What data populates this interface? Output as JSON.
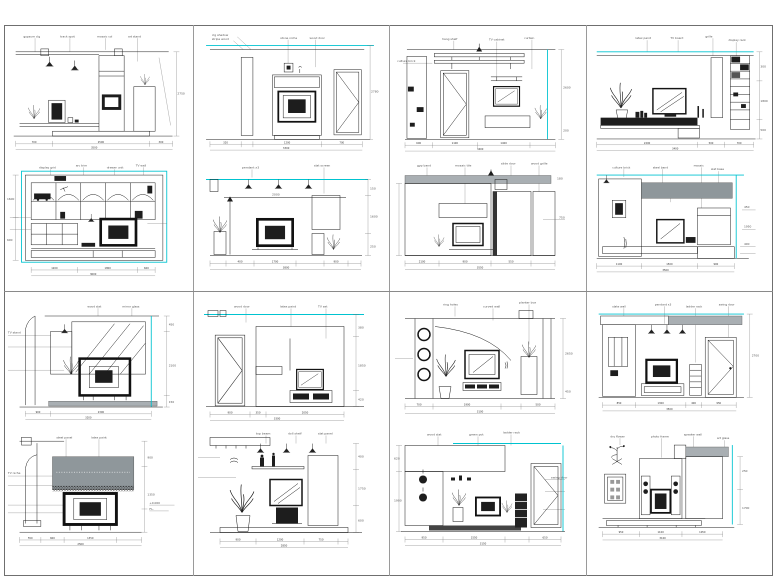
{
  "sheet": {
    "background": "#ffffff",
    "frame_color": "#6f6f6f",
    "grid_color": "#9a9a9a",
    "line_color": "#1a1a1a",
    "accent_cyan": "#00c3d0",
    "band_gray": "#a9afb3",
    "dark_fill": "#1d1d1d",
    "layout": "4 columns x 2 rows of cells, 2 elevation drawings per cell"
  },
  "panels": [
    {
      "id": "elev-1a",
      "annos": [
        "gypsum clg",
        "track spot",
        "mosaic col",
        "art stand"
      ],
      "dims": [
        "700",
        "2500",
        "300",
        "3500"
      ],
      "vdims": [
        "2750"
      ]
    },
    {
      "id": "elev-2a",
      "annos": [
        "clg shadow",
        "stripe wood",
        "stone niche",
        "wood door"
      ],
      "dims": [
        "320",
        "1200",
        "700",
        "3300"
      ],
      "vdims": [
        "2780"
      ]
    },
    {
      "id": "elev-3a",
      "annos": [
        "hang shelf",
        "culture brick",
        "TV cabinet",
        "curtain"
      ],
      "dims": [
        "600",
        "1100",
        "1400",
        "3400"
      ],
      "vdims": [
        "2600",
        "200"
      ]
    },
    {
      "id": "elev-4a",
      "annos": [
        "latex paint",
        "TV board",
        "grille",
        "display rack"
      ],
      "dims": [
        "2200",
        "500",
        "700",
        "3400"
      ],
      "vdims": [
        "300",
        "1800",
        "500"
      ]
    },
    {
      "id": "elev-1b",
      "annos": [
        "display grid",
        "arc trim",
        "drawer unit",
        "TV wall"
      ],
      "dims": [
        "1200",
        "1800",
        "600",
        "3600"
      ],
      "vdims": [
        "1600",
        "600"
      ]
    },
    {
      "id": "elev-2b",
      "annos": [
        "pendant x3",
        "2000",
        "slat screen"
      ],
      "dims": [
        "400",
        "1700",
        "900",
        "3800"
      ],
      "vdims": [
        "150",
        "1600",
        "250"
      ]
    },
    {
      "id": "elev-3b",
      "annos": [
        "gyp band",
        "mosaic tile",
        "slide door",
        "wood grille"
      ],
      "dims": [
        "2100",
        "900",
        "550",
        "3550"
      ],
      "vdims": [
        "750",
        "180"
      ]
    },
    {
      "id": "elev-4b",
      "annos": [
        "culture brick",
        "steel band",
        "mosaic",
        "slat base"
      ],
      "dims": [
        "1100",
        "1500",
        "900",
        "3500"
      ],
      "vdims": [
        "450",
        "1950",
        "400"
      ]
    },
    {
      "id": "elev-5a",
      "annos": [
        "wood slat",
        "mirror glass",
        "TV stand"
      ],
      "dims": [
        "900",
        "2300",
        "3200"
      ],
      "vdims": [
        "450",
        "2100",
        "150"
      ]
    },
    {
      "id": "elev-6a",
      "annos": [
        "wood door",
        "latex paint",
        "TV set"
      ],
      "dims": [
        "900",
        "350",
        "2050",
        "3300"
      ],
      "vdims": [
        "380",
        "1850",
        "420"
      ]
    },
    {
      "id": "elev-7a",
      "annos": [
        "ring holes",
        "curved wall",
        "planter box"
      ],
      "dims": [
        "700",
        "1900",
        "500",
        "3100"
      ],
      "vdims": [
        "2650",
        "450"
      ]
    },
    {
      "id": "elev-8a",
      "annos": [
        "slate wall",
        "pendant x3",
        "ladder rack",
        "swing door"
      ],
      "dims": [
        "850",
        "1300",
        "400",
        "950",
        "3500"
      ],
      "vdims": [
        "2700"
      ]
    },
    {
      "id": "elev-5b",
      "annos": [
        "steel panel",
        "latex paint",
        "TV niche"
      ],
      "dims": [
        "550",
        "600",
        "1350",
        "2500"
      ],
      "vdims": [
        "900",
        "1350"
      ],
      "notes": [
        "+0.000",
        "F.L."
      ]
    },
    {
      "id": "elev-6b",
      "annos": [
        "top beam",
        "doll shelf",
        "slat panel"
      ],
      "dims": [
        "900",
        "1200",
        "750",
        "2850"
      ],
      "vdims": [
        "400",
        "1750",
        "600"
      ]
    },
    {
      "id": "elev-7b",
      "annos": [
        "wood slat",
        "green pot",
        "ladder rack",
        "swing door"
      ],
      "dims": [
        "950",
        "1550",
        "650",
        "3150"
      ],
      "vdims": [
        "620",
        "1900"
      ]
    },
    {
      "id": "elev-8b",
      "annos": [
        "dry flower",
        "photo frame",
        "speaker wall",
        "art glass"
      ],
      "dims": [
        "950",
        "1100",
        "1050",
        "3100"
      ],
      "vdims": [
        "250",
        "1700"
      ]
    }
  ]
}
